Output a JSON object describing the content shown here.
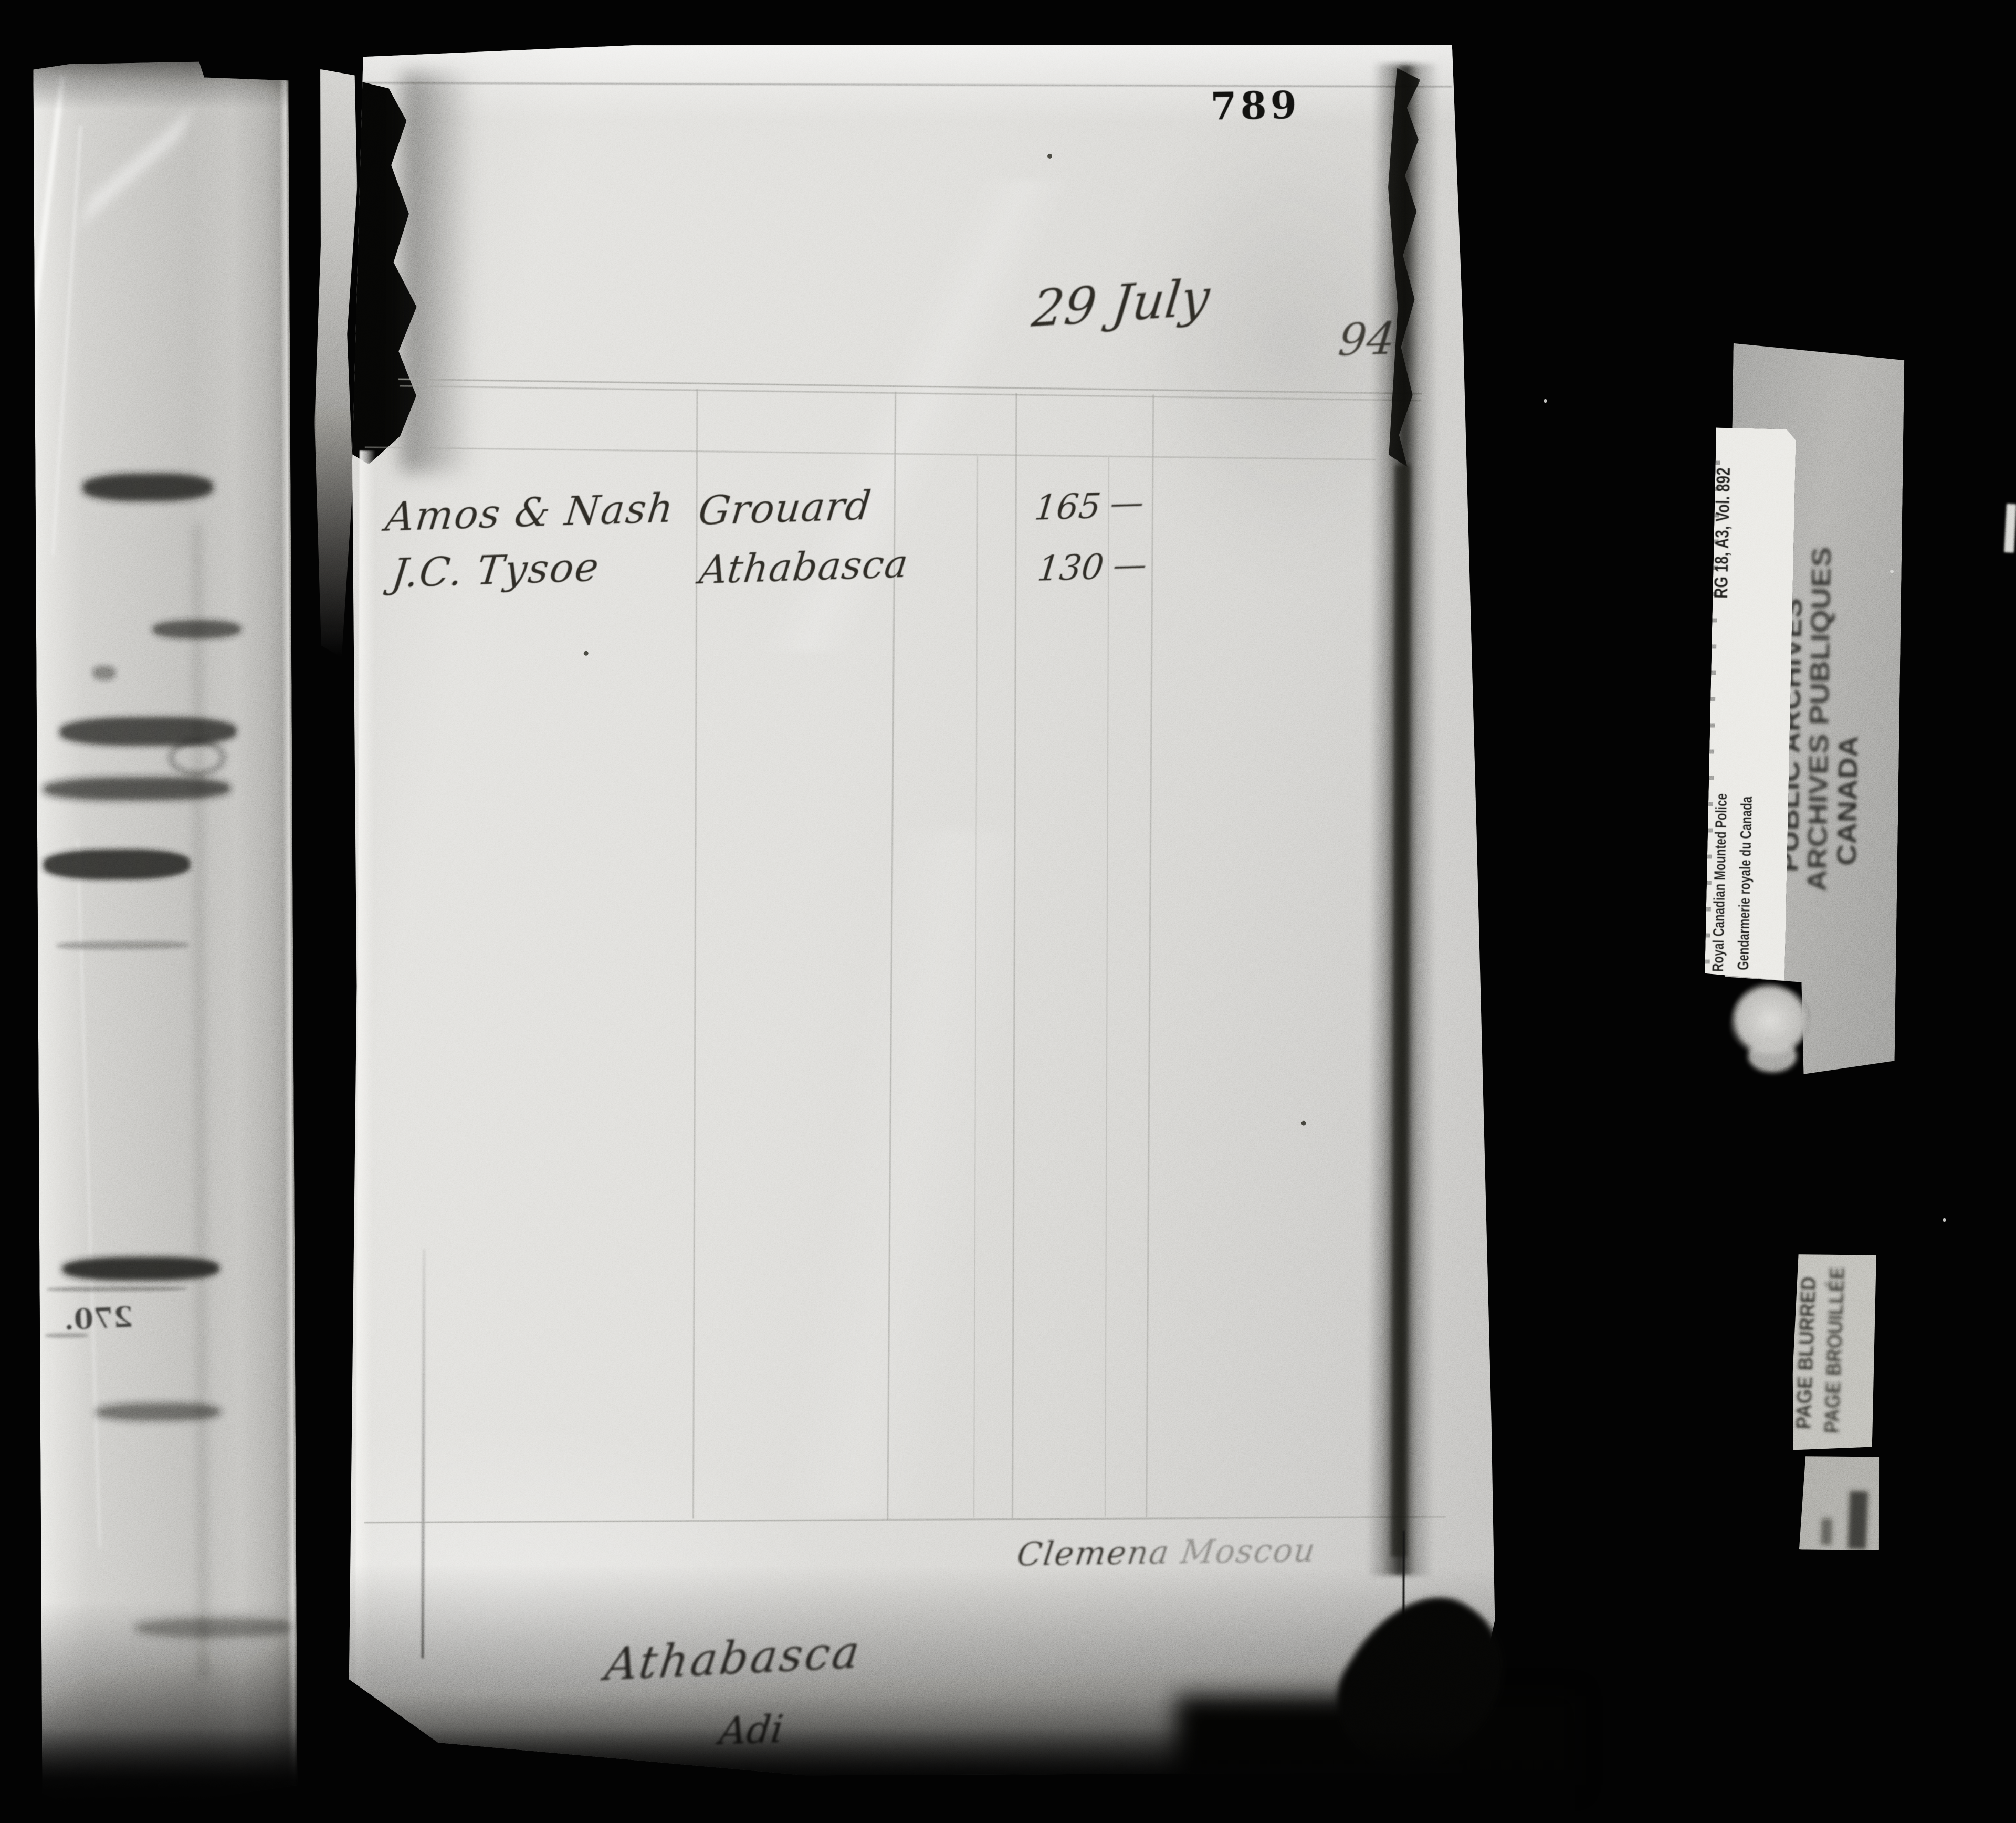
{
  "scan": {
    "page_number": "789",
    "date": "29 July",
    "year_partial": "94",
    "rows": [
      {
        "name": "Amos & Nash",
        "place": "Grouard",
        "amount": "165",
        "cents_dash": "—"
      },
      {
        "name": "J.C. Tysoe",
        "place": "Athabasca",
        "amount": "130",
        "cents_dash": "—"
      }
    ],
    "signature": "Clemena Moscou",
    "footer_place": "Athabasca",
    "footer_initials": "Adi",
    "showthrough_number": "270."
  },
  "labels": {
    "rcmp_en": "Royal Canadian Mounted Police",
    "rcmp_fr": "Gendarmerie royale du Canada",
    "reference": "RG 18, A3, Vol. 892",
    "archives_en": "PUBLIC ARCHIVES",
    "archives_fr": "ARCHIVES PUBLIQUES",
    "archives_country": "CANADA",
    "blurred_en": "PAGE BLURRED",
    "blurred_fr": "PAGE BROUILLÉE"
  },
  "colors": {
    "background": "#020202",
    "paper": "#d8d7d2",
    "ink": "#26241f",
    "pencil_line": "#8c8c86",
    "card": "#e6e5e0",
    "archive_paper": "#97968f",
    "blur_label": "#b2b1aa"
  }
}
